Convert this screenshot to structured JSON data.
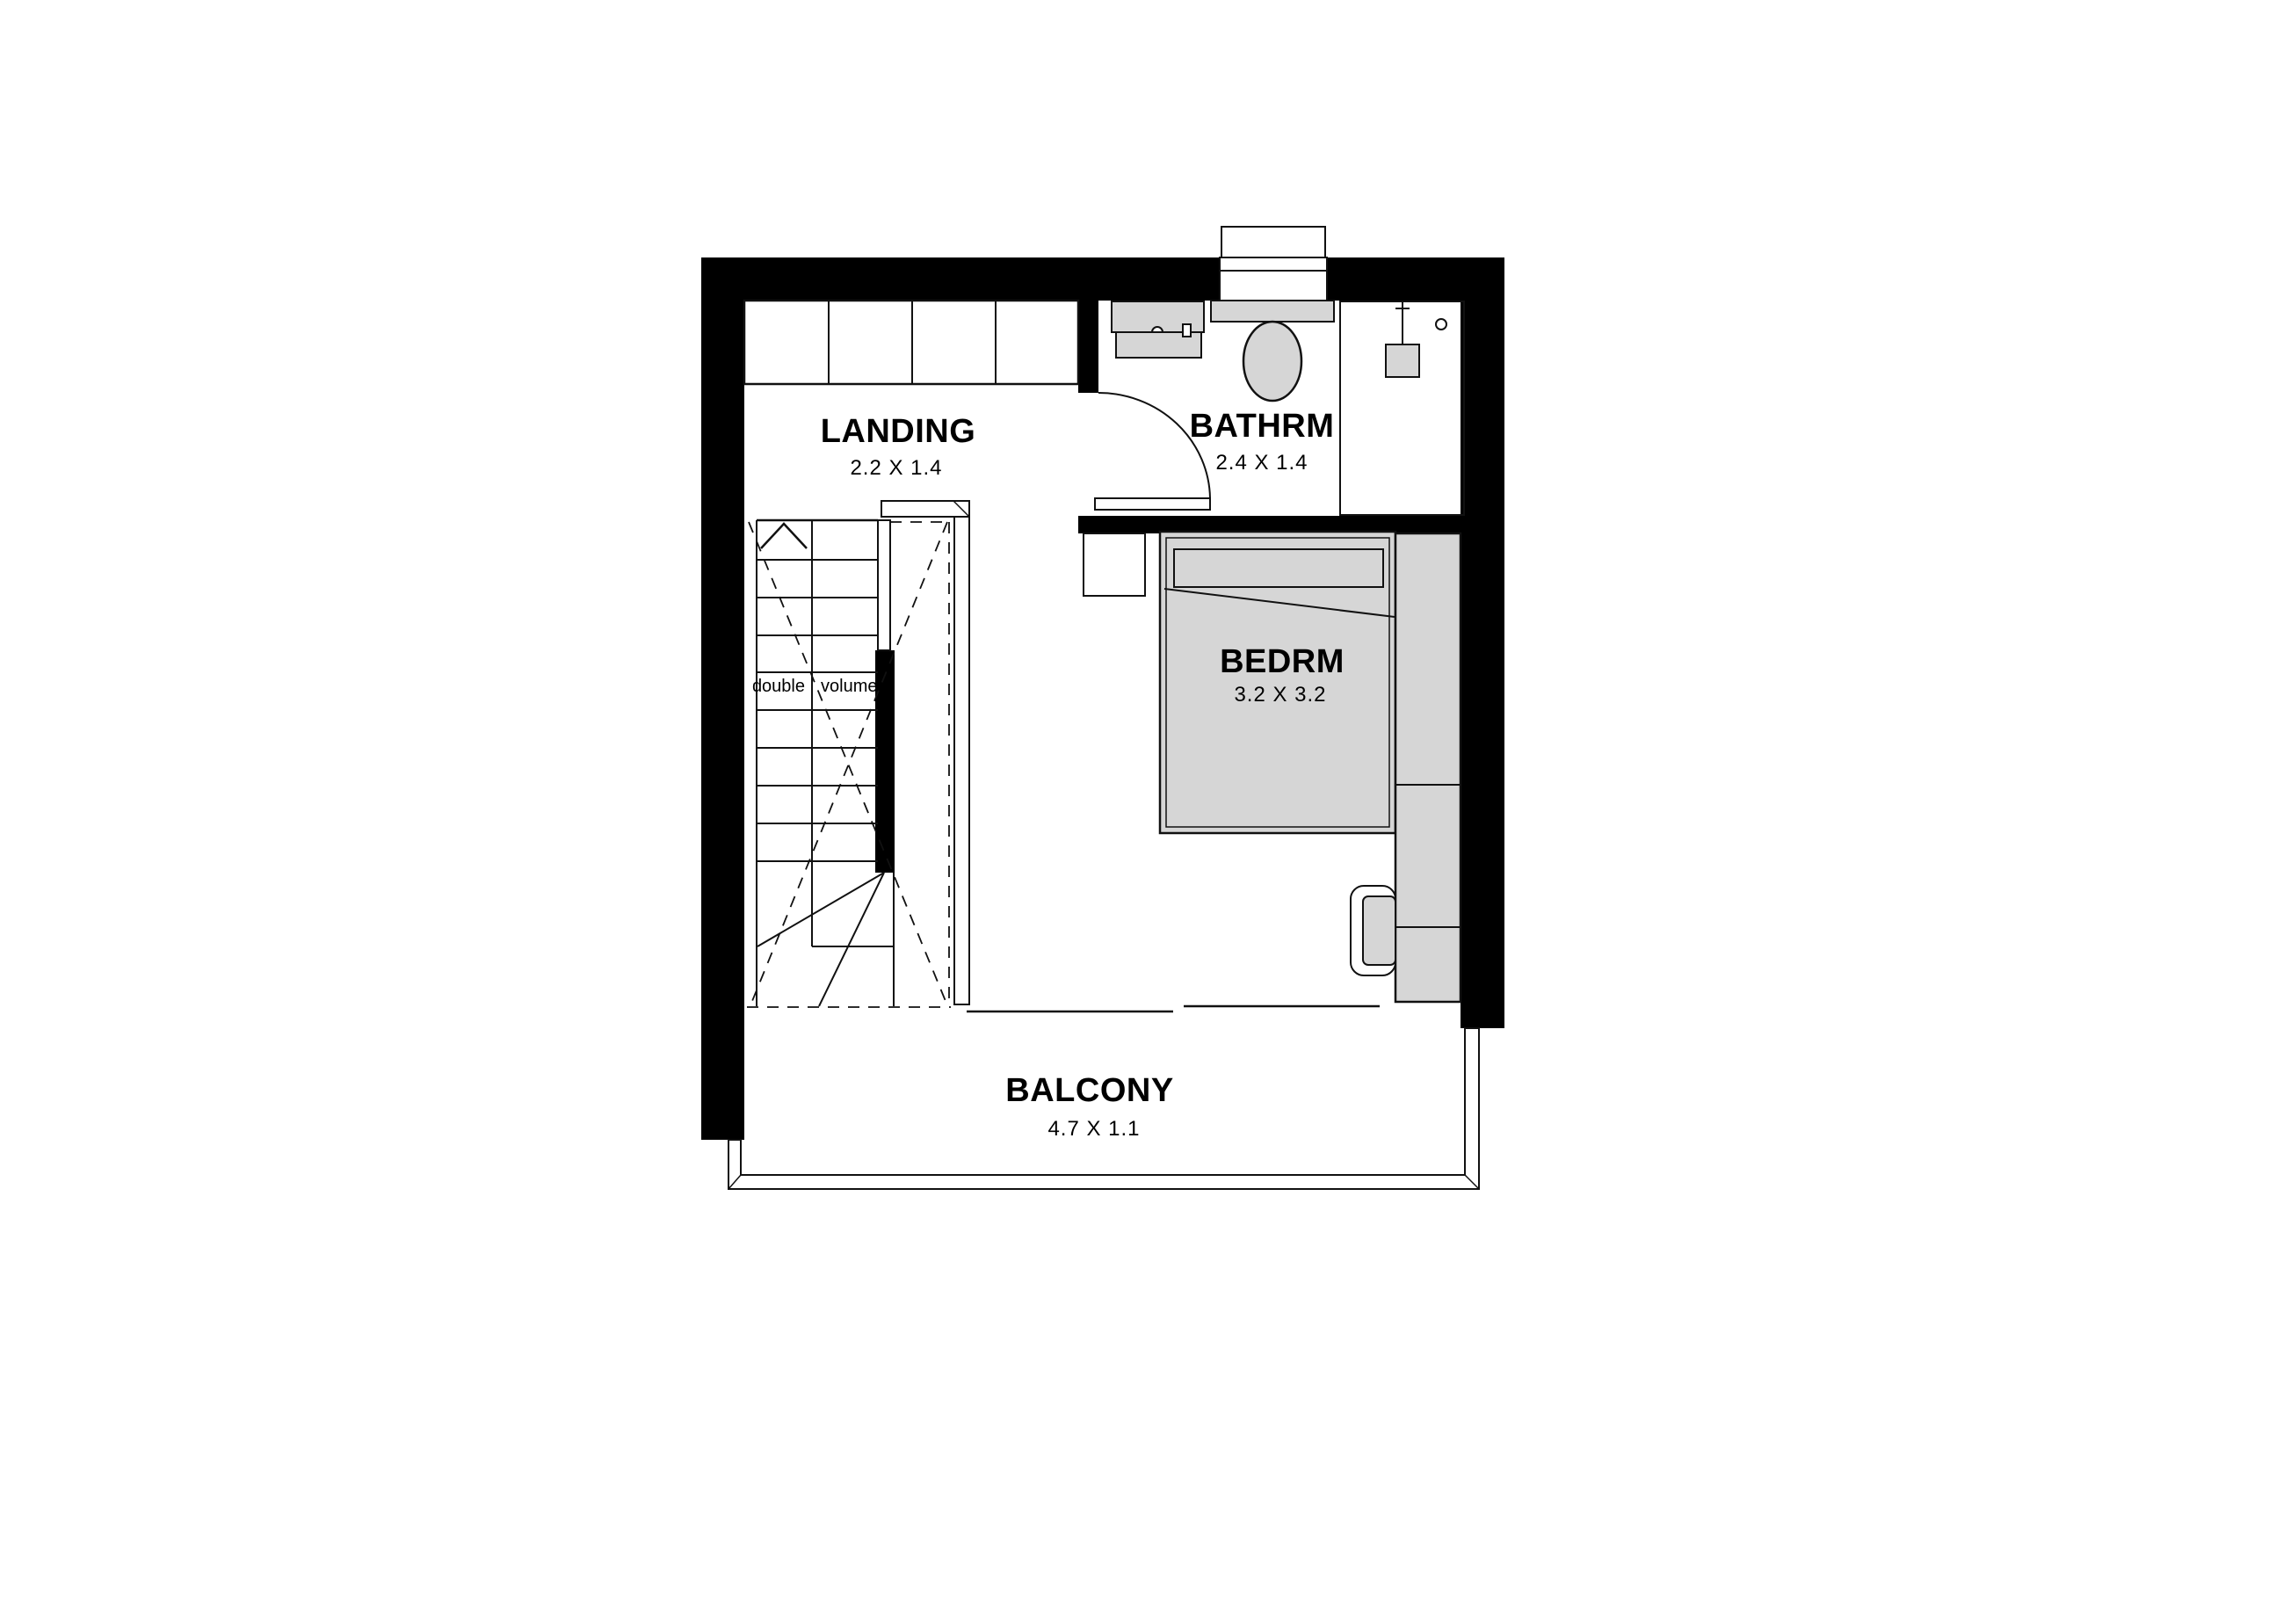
{
  "plan": {
    "colors": {
      "bg": "#ffffff",
      "wall": "#000000",
      "line": "#111111",
      "furn": "#d6d6d6",
      "text": "#000000"
    }
  },
  "rooms": {
    "landing": {
      "name": "LANDING",
      "dims": "2.2 X 1.4"
    },
    "bathroom": {
      "name": "BATHRM",
      "dims": "2.4 X 1.4"
    },
    "bedroom": {
      "name": "BEDRM",
      "dims": "3.2 X 3.2"
    },
    "balcony": {
      "name": "BALCONY",
      "dims": "4.7 X 1.1"
    }
  },
  "stairs": {
    "annotation_left": "double",
    "annotation_right": "volume"
  }
}
